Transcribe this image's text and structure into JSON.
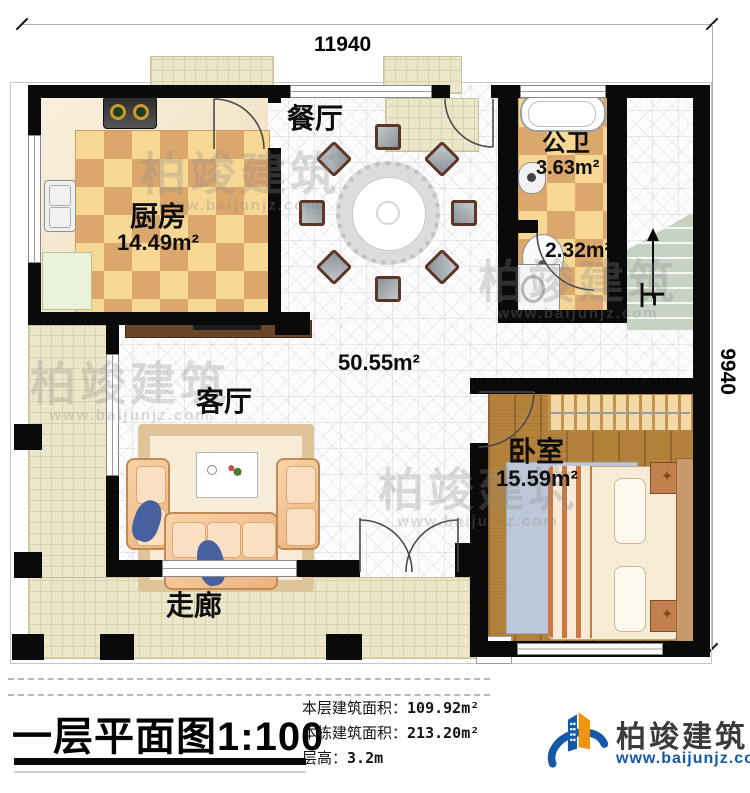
{
  "dimensions": {
    "top": "11940",
    "right": "9940"
  },
  "rooms": {
    "dining": {
      "label": "餐厅"
    },
    "kitchen": {
      "label": "厨房",
      "area": "14.49m²"
    },
    "bath": {
      "label": "公卫",
      "area": "3.63m²"
    },
    "laundry": {
      "area": "2.32m²"
    },
    "hall": {
      "area": "50.55m²"
    },
    "living": {
      "label": "客厅"
    },
    "bedroom": {
      "label": "卧室",
      "area": "15.59m²"
    },
    "corridor": {
      "label": "走廊"
    },
    "stairs": {
      "direction_label": "上"
    }
  },
  "title_block": {
    "title": "一层平面图",
    "scale": "1:100",
    "rows": [
      {
        "label": "本层建筑面积：",
        "value": "109.92m²"
      },
      {
        "label": "本栋建筑面积：",
        "value": "213.20m²"
      },
      {
        "label": "层高：",
        "value": "3.2m"
      }
    ]
  },
  "branding": {
    "company": "柏竣建筑",
    "website": "www.baijunjz.com"
  },
  "watermark": {
    "company": "柏竣建筑",
    "website": "www.baijunjz.com"
  },
  "colors": {
    "brand_blue": "#1559a6",
    "brand_orange": "#f0940f",
    "wall": "#0a0a0a"
  }
}
